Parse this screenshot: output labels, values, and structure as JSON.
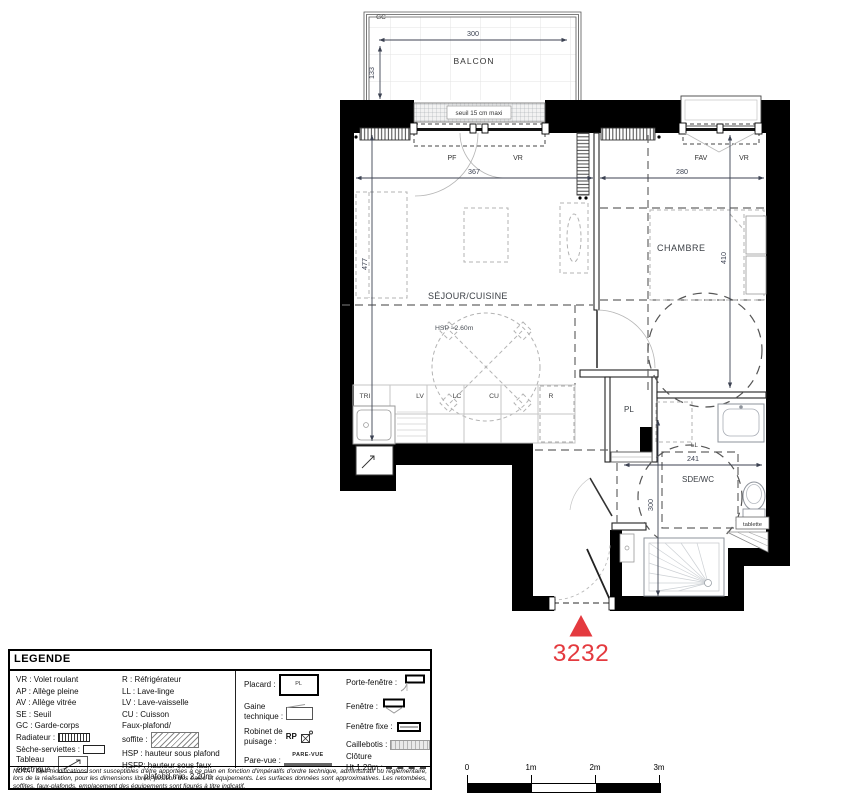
{
  "colors": {
    "accent_red": "#e43a3f",
    "wall": "#000000"
  },
  "plan": {
    "lot_number": "3232",
    "balcony": {
      "label": "BALCON",
      "gc_label": "GC",
      "width_dim": "300",
      "depth_dim": "133",
      "seuil_label": "seuil 15 cm maxi"
    },
    "windows": {
      "pf_label": "PF",
      "vr_left_label": "VR",
      "fav_label": "FAV",
      "vr_right_label": "VR"
    },
    "dims": {
      "sejour_width": "367",
      "chambre_width": "280",
      "sejour_depth": "477",
      "chambre_depth": "410",
      "sde_width": "241",
      "sde_depth": "300"
    },
    "rooms": {
      "sejour": "SÉJOUR/CUISINE",
      "sejour_hsp": "HSP ≈2.60m",
      "chambre": "CHAMBRE",
      "placard": "PL",
      "sde": "SDE/WC"
    },
    "kitchen": {
      "tri": "TRI",
      "lv": "LV",
      "lc": "LC",
      "cu": "CU",
      "r": "R"
    },
    "sde": {
      "ll": "LL",
      "tablette": "tablette"
    }
  },
  "legend": {
    "title": "LEGENDE",
    "col1": {
      "vr": "VR : Volet roulant",
      "ap": "AP : Allège pleine",
      "av": "AV : Allège vitrée",
      "se": "SE : Seuil",
      "gc": "GC : Garde-corps",
      "radiateur": "Radiateur :",
      "seche": "Sèche-serviettes :",
      "tableau_l1": "Tableau",
      "tableau_l2": "électrique :"
    },
    "col2": {
      "r": "R : Réfrigérateur",
      "ll": "LL : Lave-linge",
      "lv": "LV : Lave-vaisselle",
      "cu": "CU : Cuisson",
      "faux_l1": "Faux-plafond/",
      "faux_l2": "soffite :",
      "hsp": "HSP : hauteur sous plafond",
      "hsfp_l1": "HSFP: hauteur sous faux",
      "hsfp_l2": "plafond min. 2.20m"
    },
    "col3": {
      "placard": "Placard :",
      "placard_sym": "PL",
      "gaine_l1": "Gaine",
      "gaine_l2": "technique :",
      "robinet_l1": "Robinet de",
      "robinet_l2": "puisage :",
      "rp": "RP",
      "parevue": "Pare-vue :",
      "parevue_sym": "PARE-VUE"
    },
    "col4": {
      "pf": "Porte-fenêtre :",
      "fenetre": "Fenêtre :",
      "fenetre_fixe": "Fenêtre fixe :",
      "caillebotis": "Caillebotis :",
      "cloture_l1": "Clôture",
      "cloture_l2": "Ht 1.20m :"
    }
  },
  "nota": "NOTA : Des modifications sont susceptibles d'être apportées à ce plan en fonction d'impératifs d'ordre technique, administratif ou réglementaire, lors de la réalisation, pour les dimensions libres, position des baies et équipements. Les surfaces données sont approximatives. Les retombées, soffites, faux-plafonds, emplacement des équipements sont figurés à titre indicatif.",
  "scalebar": {
    "t0": "0",
    "t1": "1m",
    "t2": "2m",
    "t3": "3m"
  }
}
